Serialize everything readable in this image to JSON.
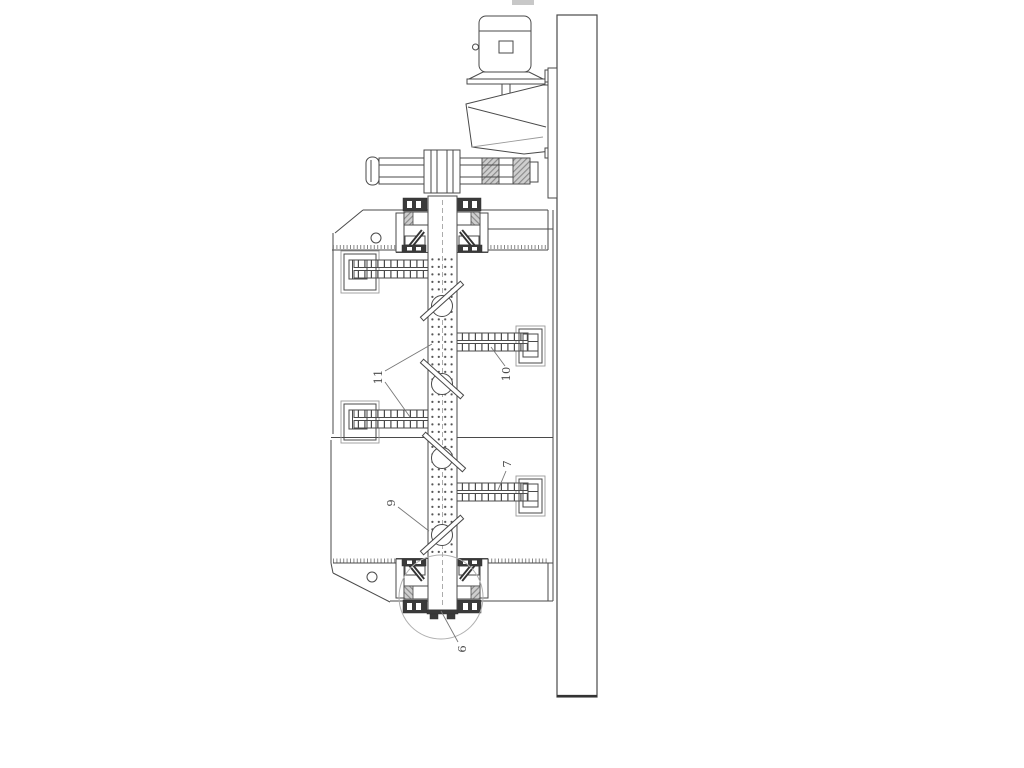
{
  "figure": {
    "kind": "patent-technical-drawing",
    "description": "Side sectional view of a wall-mounted agitator: motor and gear reducer on top, coupling, upper and lower bearing assemblies, tank shell, perforated agitator shaft with paddle arms",
    "background_color": "#ffffff",
    "line_color": "#4a4a4a",
    "dark_fill_color": "#3a3a3a",
    "hatch_fill_color": "#cfcfcf",
    "detail_circle_color": "#b0b0b0",
    "callouts": [
      {
        "label": "11",
        "target": "shaft-perforations-and-left-arm"
      },
      {
        "label": "10",
        "target": "upper-right-paddle-arm"
      },
      {
        "label": "7",
        "target": "lower-right-paddle-arm"
      },
      {
        "label": "9",
        "target": "agitator-shaft"
      },
      {
        "label": "6",
        "target": "bottom-bearing-end-cap"
      }
    ]
  }
}
